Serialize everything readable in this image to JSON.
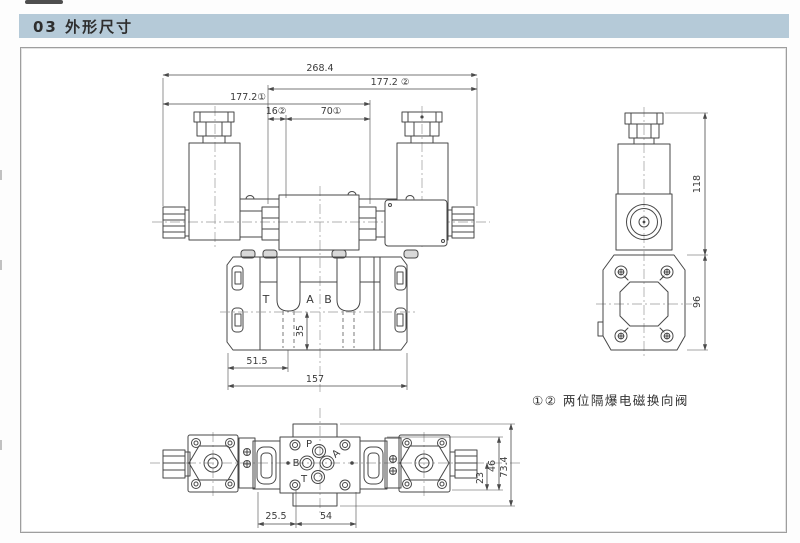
{
  "header": {
    "title": "03 外形尺寸"
  },
  "front_view": {
    "dim_overall": "268.4",
    "dim_width_2": "177.2 ②",
    "dim_width_1": "177.2①",
    "dim_16": "16②",
    "dim_70": "70①",
    "port_t": "T",
    "port_a": "A",
    "port_b": "B",
    "dim_35": "35",
    "dim_51_5": "51.5",
    "dim_157": "157"
  },
  "side_view": {
    "dim_118": "118",
    "dim_96": "96"
  },
  "bottom_view": {
    "port_p": "P",
    "port_a": "A",
    "port_b": "B",
    "port_t": "T",
    "dim_23": "23",
    "dim_46": "46",
    "dim_73_4": "73.4",
    "dim_25_5": "25.5",
    "dim_54": "54"
  },
  "caption": {
    "text": "①② 两位隔爆电磁换向阀"
  },
  "colors": {
    "header_bg": "#b5cad8",
    "line": "#474747",
    "centerline": "#999999",
    "page_bg": "#ffffff"
  }
}
